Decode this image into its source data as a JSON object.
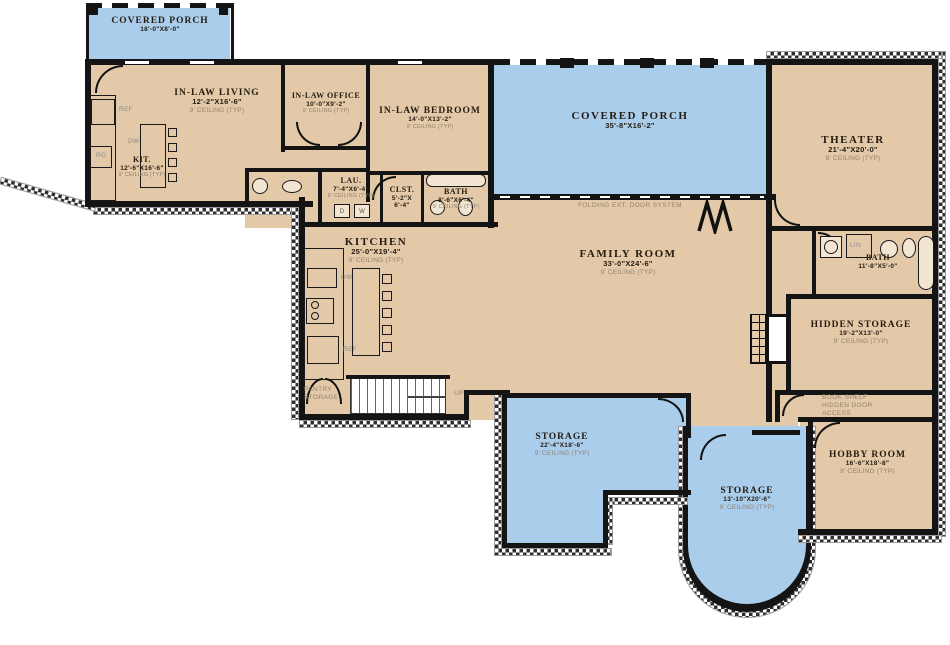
{
  "colors": {
    "room": "#e3c9a8",
    "porch": "#aacdeb",
    "wall": "#141414"
  },
  "rooms": {
    "porch_nw": {
      "name": "COVERED PORCH",
      "dims": "18'-0\"X8'-0\""
    },
    "in_law_living": {
      "name": "IN-LAW LIVING",
      "dims": "12'-2\"X16'-6\"",
      "ceiling": "9' CEILING (TYP)"
    },
    "in_law_office": {
      "name": "IN-LAW OFFICE",
      "dims": "10'-0\"X9'-2\"",
      "ceiling": "9' CEILING (TYP)"
    },
    "in_law_bedroom": {
      "name": "IN-LAW BEDROOM",
      "dims": "14'-0\"X13'-2\"",
      "ceiling": "9' CEILING (TYP)"
    },
    "kit": {
      "name": "KIT.",
      "dims": "12'-6\"X16'-6\"",
      "ceiling": "9' CEILING (TYP)"
    },
    "porch_n": {
      "name": "COVERED PORCH",
      "dims": "35'-8\"X16'-2\""
    },
    "theater": {
      "name": "THEATER",
      "dims": "21'-4\"X20'-0\"",
      "ceiling": "9' CEILING (TYP)"
    },
    "lau": {
      "name": "LAU.",
      "dims": "7'-4\"X6'-4\"",
      "ceiling": "9' CEILING (TYP)"
    },
    "clst": {
      "name": "CLST.",
      "dims": "5'-2\"X 6'-4\""
    },
    "bath_hall": {
      "name": "BATH",
      "dims": "8'-6\"X6'-4\"",
      "ceiling": "9' CEILING (TYP)"
    },
    "kitchen": {
      "name": "KITCHEN",
      "dims": "25'-0\"X19'-4\"",
      "ceiling": "9' CEILING (TYP)"
    },
    "family_room": {
      "name": "FAMILY ROOM",
      "dims": "33'-0\"X24'-6\"",
      "ceiling": "9' CEILING (TYP)"
    },
    "bath_main": {
      "name": "BATH",
      "dims": "11'-8\"X5'-0\""
    },
    "hidden_storage": {
      "name": "HIDDEN STORAGE",
      "dims": "19'-2\"X13'-0\"",
      "ceiling": "9' CEILING (TYP)"
    },
    "hobby": {
      "name": "HOBBY ROOM",
      "dims": "16'-6\"X18'-8\"",
      "ceiling": "9' CEILING (TYP)"
    },
    "storage_w": {
      "name": "STORAGE",
      "dims": "22'-4\"X18'-6\"",
      "ceiling": "9' CEILING (TYP)"
    },
    "storage_s": {
      "name": "STORAGE",
      "dims": "13'-10\"X20'-6\"",
      "ceiling": "9' CEILING (TYP)"
    },
    "pantry": {
      "name": "PANTRY STORAGE"
    }
  },
  "notes": {
    "folding_door": "FOLDING EXT. DOOR SYSTEM",
    "book_shelf": "BOOK SHELF HIDDEN DOOR ACCESS",
    "up": "UP"
  },
  "appliances": {
    "ref": "REF",
    "dw": "DW",
    "rg": "RG",
    "lin": "LIN",
    "washer": "W",
    "dryer": "D"
  }
}
